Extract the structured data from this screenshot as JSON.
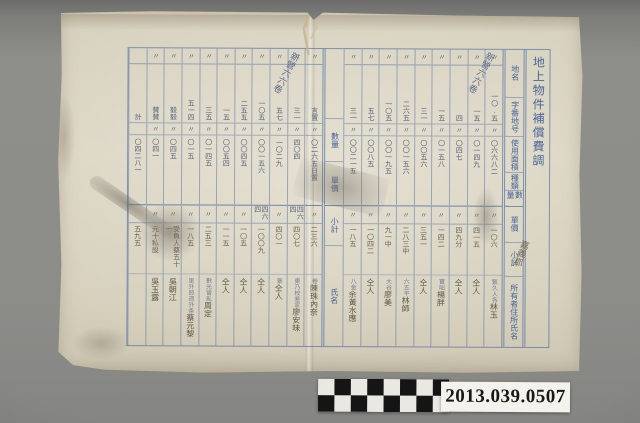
{
  "photo": {
    "background_color": "#8c8c89",
    "catalog_number": "2013.039.0507",
    "scale_bar": {
      "pattern": "checkerboard",
      "rows": 2,
      "columns": 8,
      "dark": "#151515",
      "light": "#e9e8e3"
    }
  },
  "document": {
    "description": "Handwritten ledger table in vertical script on aged folded paper, blue ruled grid",
    "paper_color": "#d8d2c0",
    "grid_color": "#4a6ba2",
    "ink_color": "#41506d",
    "pencil_color": "#645c4c",
    "title": "地上物件補償費調",
    "archive_annotation": "新營六六卷",
    "district_annotation": "嘉義郡",
    "ditto_mark": "〃",
    "headers_right": {
      "labels": [
        "地名",
        "字番地号",
        "使用面積",
        "種類",
        "數量",
        "單價",
        "小計",
        "所有者住所氏名"
      ]
    },
    "headers_middle": {
      "labels": [
        "數量",
        "單價",
        "小計",
        "氏名"
      ]
    },
    "table": {
      "columns_right": [
        {
          "t1": "〃",
          "v1": "一〇.五",
          "t2": "〃",
          "v2": "〇六六八二",
          "t3": "〃",
          "v3": "一〇六",
          "kind": "繁久人各",
          "name": "林玉"
        },
        {
          "t1": "〃",
          "v1": "一五",
          "t2": "〃",
          "v2": "〇一四九",
          "t3": "〃",
          "v3": "四一五",
          "kind": "",
          "name": "仝人"
        },
        {
          "t1": "〃",
          "v1": "四",
          "t2": "〃",
          "v2": "〇四七",
          "t3": "〃",
          "v3": "四九分",
          "kind": "",
          "name": "仝人"
        },
        {
          "t1": "〃",
          "v1": "一五",
          "t2": "〃",
          "v2": "〇一五八",
          "t3": "〃",
          "v3": "一四二",
          "kind": "寶咄",
          "name": "楊胖"
        },
        {
          "t1": "〃",
          "v1": "三一",
          "t2": "〃",
          "v2": "〇〇五六",
          "t3": "〃",
          "v3": "三五一",
          "kind": "",
          "name": "仝人"
        },
        {
          "t1": "〃",
          "v1": "二六五",
          "t2": "〃",
          "v2": "〇〇一五六",
          "t3": "〃",
          "v3": "二八三中",
          "kind": "六五平",
          "name": "林師"
        },
        {
          "t1": "〃",
          "v1": "一〇五",
          "t2": "〃",
          "v2": "〇〇一九五",
          "t3": "〃",
          "v3": "九一中",
          "kind": "大谷",
          "name": "廖美"
        },
        {
          "t1": "〃",
          "v1": "五七",
          "t2": "〃",
          "v2": "〇〇八五",
          "t3": "〃",
          "v3": "一〇四二",
          "kind": "",
          "name": "仝人"
        },
        {
          "t1": "〃",
          "v1": "三一",
          "t2": "〃",
          "v2": "〇〇二一五",
          "t3": "〃",
          "v3": "一八五",
          "kind": "八金",
          "name": "余黃水應"
        }
      ],
      "columns_left": [
        {
          "t1": "〃",
          "v1": "言置",
          "t2": "〃",
          "v2": "〇二六五日置",
          "t3": "〃",
          "v3": "二三六",
          "kind": "卷",
          "name": "陳珠內奈"
        },
        {
          "t1": "〃",
          "v1": "三一",
          "t2": "〃",
          "v2": "四〇四",
          "t3": "四六四",
          "v3": "四〇七",
          "kind": "東乃校差家",
          "name": "廖安味"
        },
        {
          "t1": "〃",
          "v1": "五七",
          "t2": "〃",
          "v2": "一〇二九",
          "t3": "〃",
          "v3": "四〇一",
          "kind": "寨",
          "name": "仝人"
        },
        {
          "t1": "〃",
          "v1": "一〇五",
          "t2": "〃",
          "v2": "〇〇一五六",
          "t3": "四六四",
          "v3": "一〇〇九",
          "kind": "",
          "name": "仝人"
        },
        {
          "t1": "〃",
          "v1": "二五五",
          "t2": "〃",
          "v2": "〇〇四五",
          "t3": "〃",
          "v3": "一〇五",
          "kind": "",
          "name": "仝人"
        },
        {
          "t1": "〃",
          "v1": "一五",
          "t2": "〃",
          "v2": "〇〇五四",
          "t3": "〃",
          "v3": "一一五",
          "kind": "",
          "name": "仝人"
        },
        {
          "t1": "〃",
          "v1": "三五",
          "t2": "〃",
          "v2": "〇一四五",
          "t3": "〃",
          "v3": "二五三",
          "kind": "數光管亂",
          "name": "周定"
        },
        {
          "t1": "〃",
          "v1": "五一四",
          "t2": "〃",
          "v2": "〇一五",
          "t3": "〃",
          "v3": "一八五",
          "kind": "里外郎週外条",
          "name": "蔡元黎"
        },
        {
          "t1": "〃",
          "v1": "毅毅",
          "t2": "〃",
          "v2": "〇四五",
          "t3": "〃",
          "v3": "受負人蔡五十一",
          "kind": "",
          "name": "吳朝江"
        },
        {
          "t1": "〃",
          "v1": "賛賛",
          "t2": "〃",
          "v2": "〇四一",
          "t3": "〃",
          "v3": "元十私設",
          "kind": "",
          "name": "吳玉露"
        },
        {
          "t1": "",
          "v1": "計",
          "t2": "",
          "v2": "〇四二八一",
          "t3": "",
          "v3": "五九五",
          "kind": "",
          "name": ""
        }
      ]
    }
  }
}
